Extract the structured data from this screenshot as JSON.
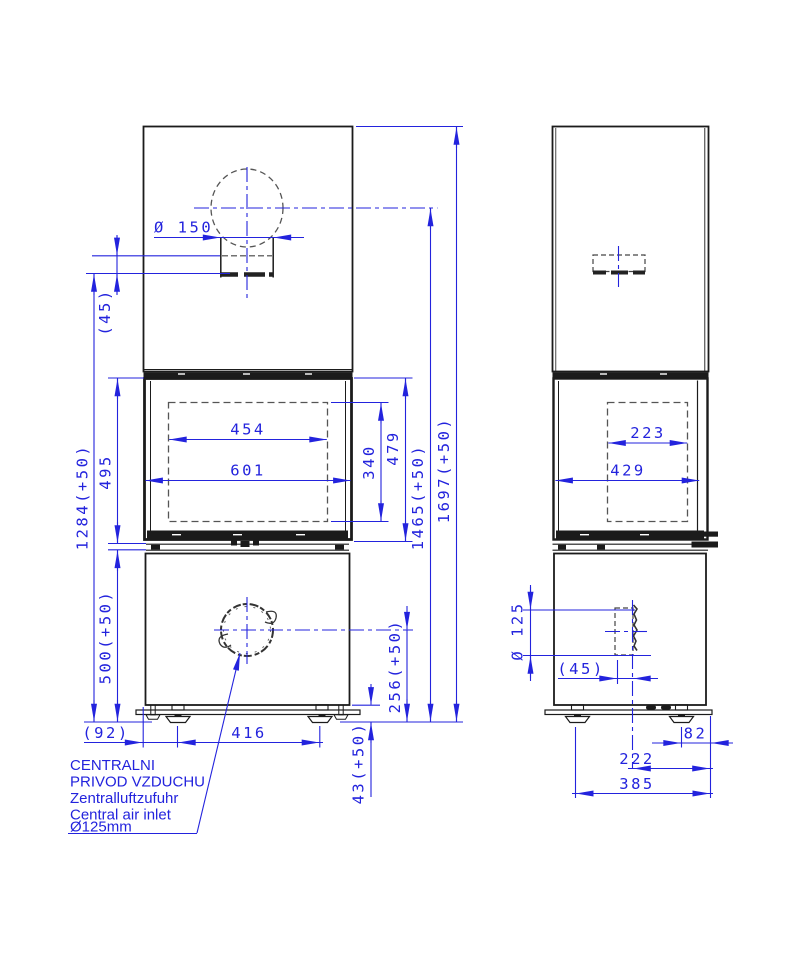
{
  "drawing": {
    "type": "technical-dimension-drawing",
    "subject": "fireplace stove front and side elevation",
    "colors": {
      "dimension_blue": "#2323dd",
      "outline_black": "#1b1b1b",
      "hidden_line_gray": "#555555"
    }
  },
  "front_view": {
    "dimensions": {
      "flue_pipe_diameter": "Ø 150",
      "flue_collar_height": "(45)",
      "glass_width": "454",
      "body_width": "601",
      "glass_height": "340",
      "door_height": "479",
      "middle_section_height": "495",
      "collar_to_floor_height": "1284(+50)",
      "base_section_height": "500(+50)",
      "flue_axis_height": "1465(+50)",
      "overall_height": "1697(+50)",
      "air_inlet_axis_height": "256(+50)",
      "floor_clearance": "43(+50)",
      "edge_to_foot": "(92)",
      "feet_spacing": "416"
    }
  },
  "side_view": {
    "dimensions": {
      "glass_depth": "223",
      "body_depth": "429",
      "air_inlet_diameter": "Ø 125",
      "air_inlet_offset": "(45)",
      "foot_to_back_edge": "82",
      "inlet_axis_to_back_edge": "222",
      "feet_span": "385"
    }
  },
  "air_inlet_note": {
    "lines": [
      "CENTRALNI",
      " PRIVOD VZDUCHU",
      "Zentralluftzufuhr",
      "Central air inlet",
      "Ø125mm"
    ]
  }
}
